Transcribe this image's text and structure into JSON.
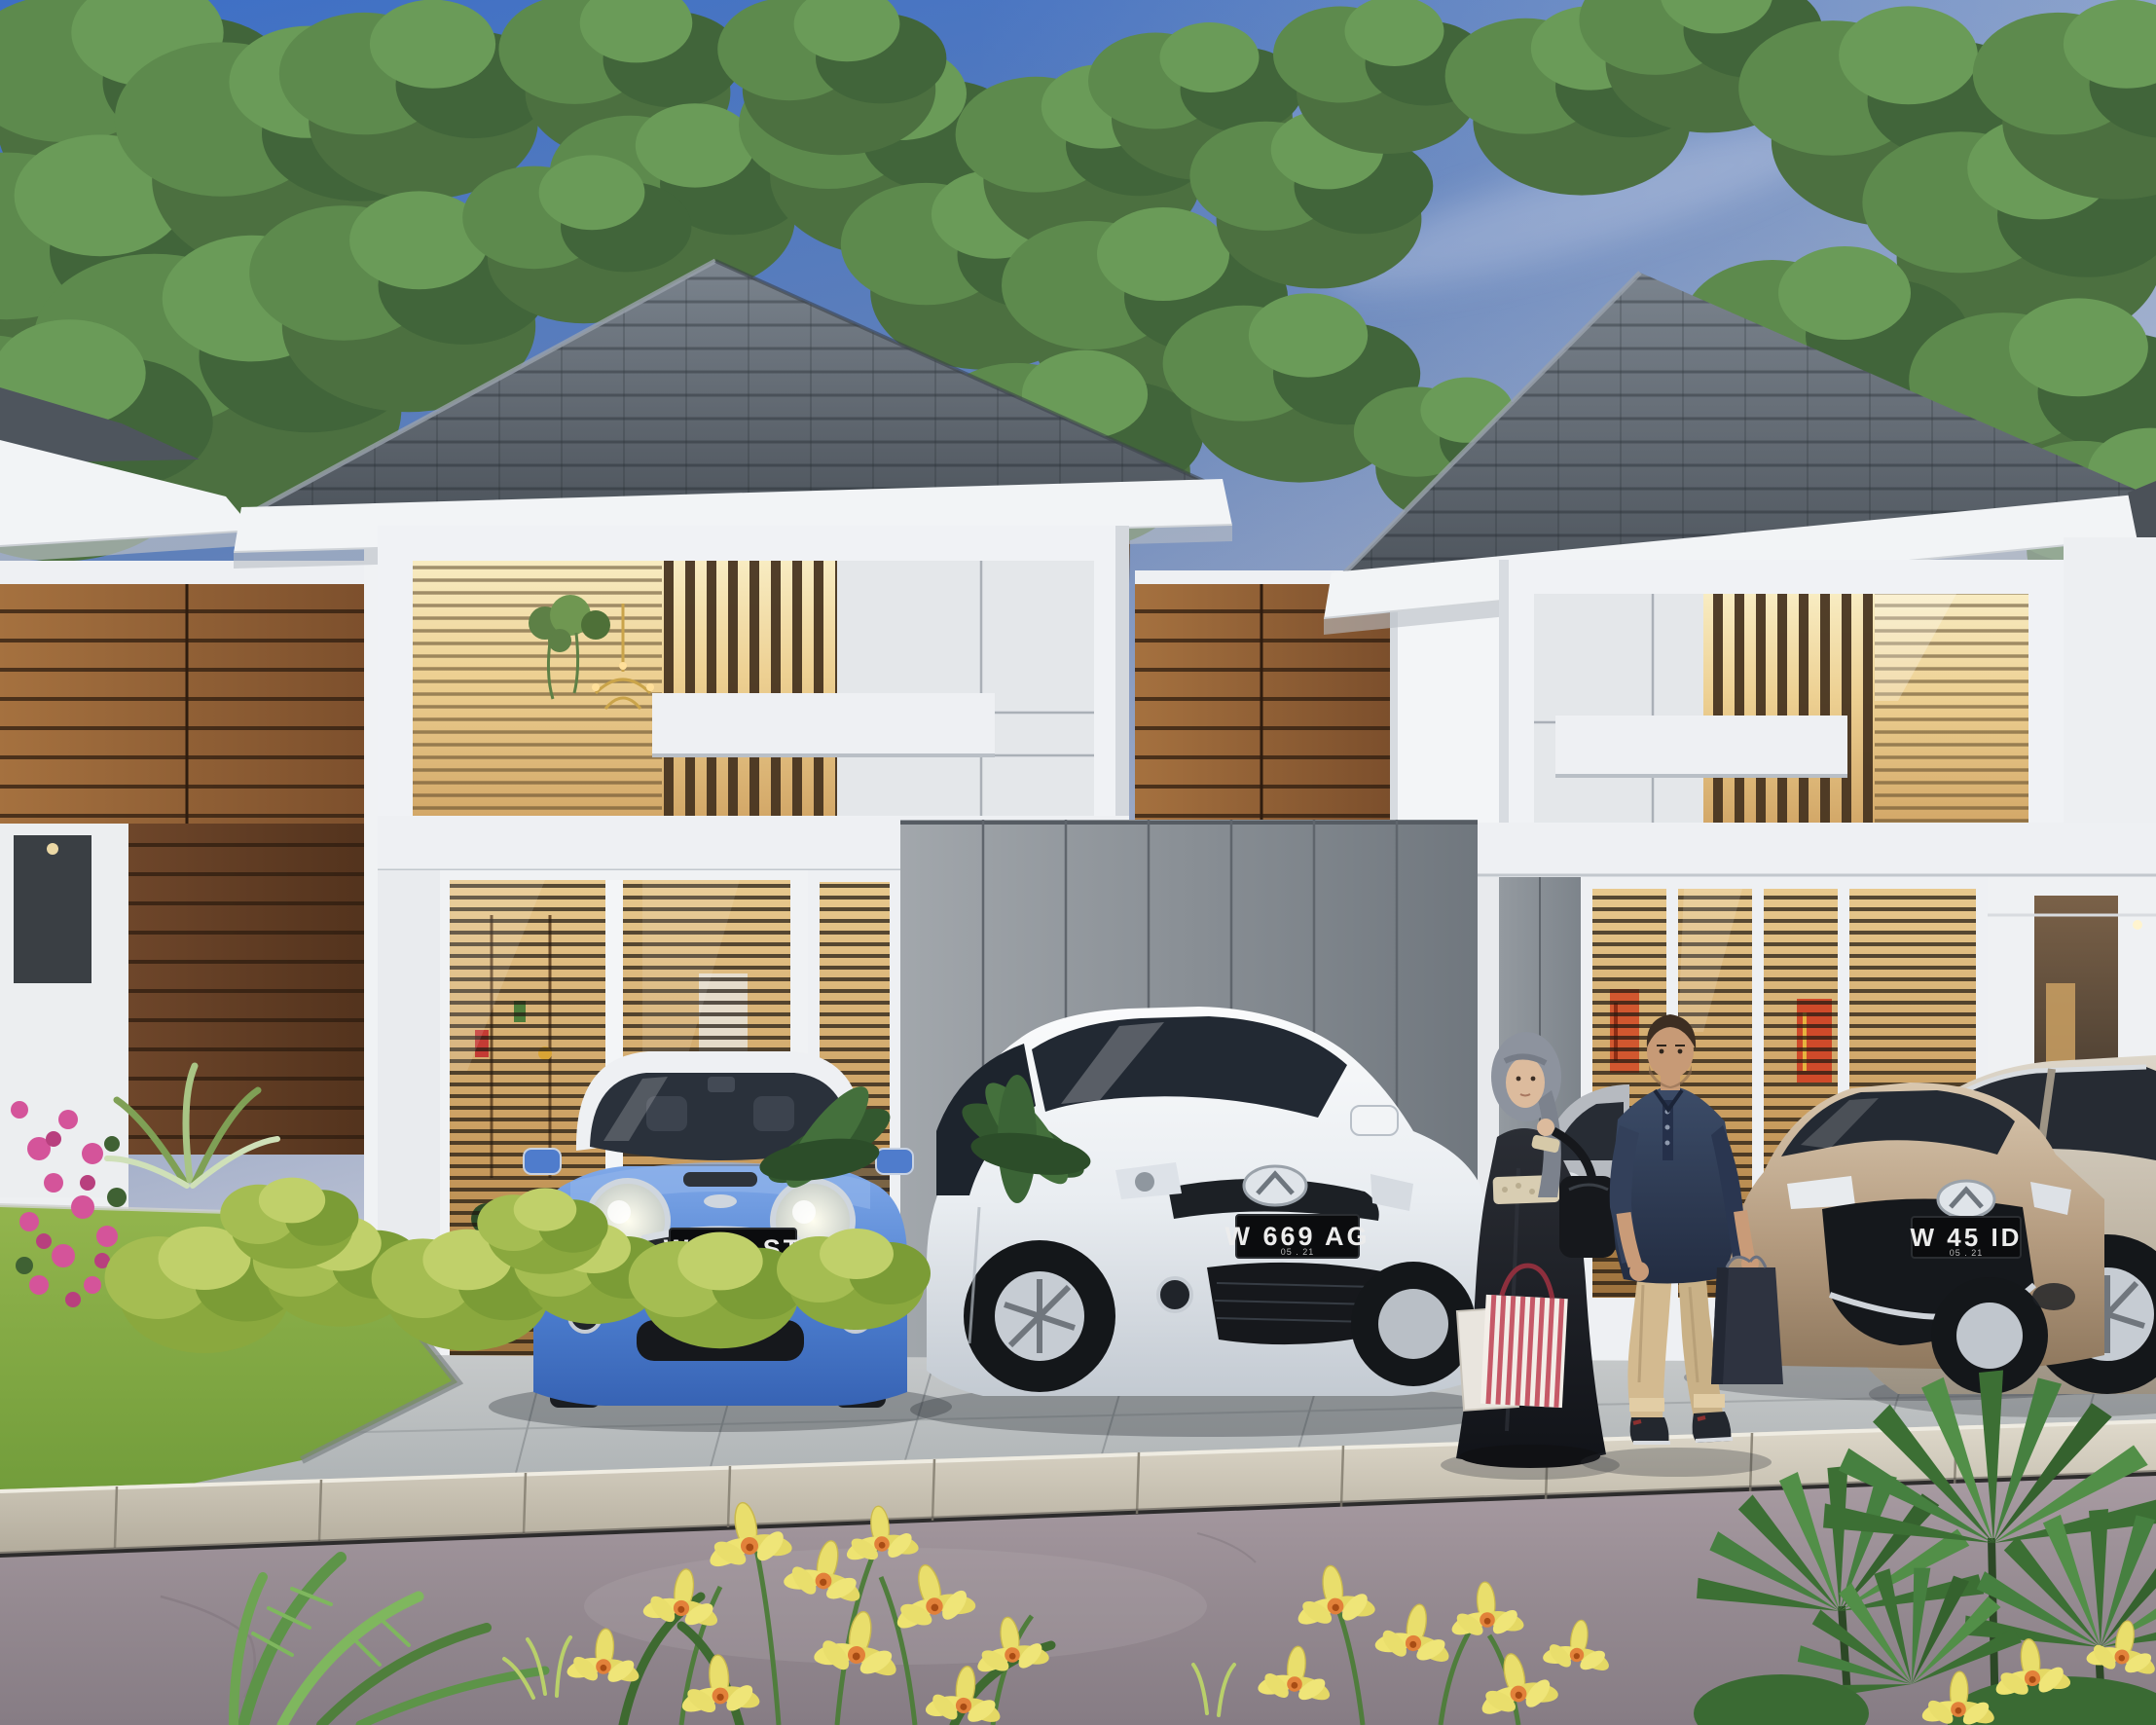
{
  "scene": {
    "type": "3D architectural exterior rendering",
    "time_of_day": "dusk",
    "description": "Row of modern minimalist two-storey houses with grey hip roofs, white box facades, walnut wood and grey stone accent walls and warmly lit windows; four cars parked on the front driveway; a couple with shopping bags standing between the cars; lawn, shrubs and yellow orchids in the foreground."
  },
  "vehicles": [
    {
      "name": "blue MINI Cooper hatchback",
      "plate": "W 119 ST",
      "plate_expiry": "05 . 21",
      "color_hex": "#4d7fd0"
    },
    {
      "name": "white Mazda CX-7 SUV",
      "plate": "W 669 AG",
      "plate_expiry": "05 . 21",
      "color_hex": "#edf0f3"
    },
    {
      "name": "bronze Mazda3 sedan",
      "plate": "W 45 ID",
      "plate_expiry": "05 . 21",
      "color_hex": "#b49b7f"
    },
    {
      "name": "champagne sedan at right edge",
      "plate": "",
      "color_hex": "#c2b8a7"
    }
  ],
  "people": [
    {
      "name": "woman",
      "outfit": "grey hijab, black abaya with cream lace belt and cuffs, black shoulder bag, red-striped and white shopping bags"
    },
    {
      "name": "man",
      "outfit": "navy henley shirt, khaki chinos, dark sneakers, dark shopping bag"
    }
  ],
  "palette": {
    "sky_top": "#3d6fc6",
    "roof": "#5a6269",
    "wood_accent": "#8a5c38",
    "stone_wall": "#7e858c",
    "warm_window": "#edd092",
    "lawn": "#7ba43f",
    "road": "#968b92",
    "plate_bg": "#0b0c0e"
  }
}
